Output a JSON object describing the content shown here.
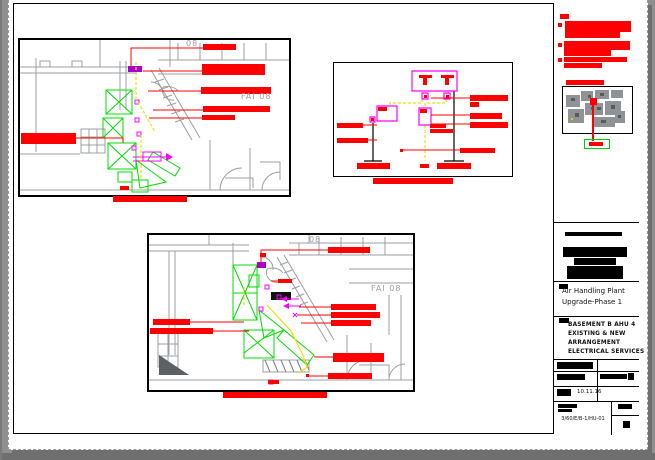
{
  "title_block": {
    "project_title": [
      "Air Handling Plant",
      "Upgrade-Phase 1"
    ],
    "drawing_title": [
      "BASEMENT B AHU 4",
      "EXISTING & NEW",
      "ARRANGEMENT",
      "ELECTRICAL SERVICES"
    ],
    "date": "10.11.16",
    "drawing_number": "3/60/E/B-1/HU-01"
  },
  "plan_labels": {
    "fai_room": "FAI 08",
    "room_partial": "08"
  },
  "colors": {
    "annotation_red": "#ff0000",
    "equipment_green": "#00dd00",
    "services_magenta": "#ff00ff",
    "cable_yellow": "#f0e000",
    "plan_line_gray": "#9b9fa2",
    "paper_white": "#ffffff",
    "desktop_gray": "#8f8f8f"
  }
}
